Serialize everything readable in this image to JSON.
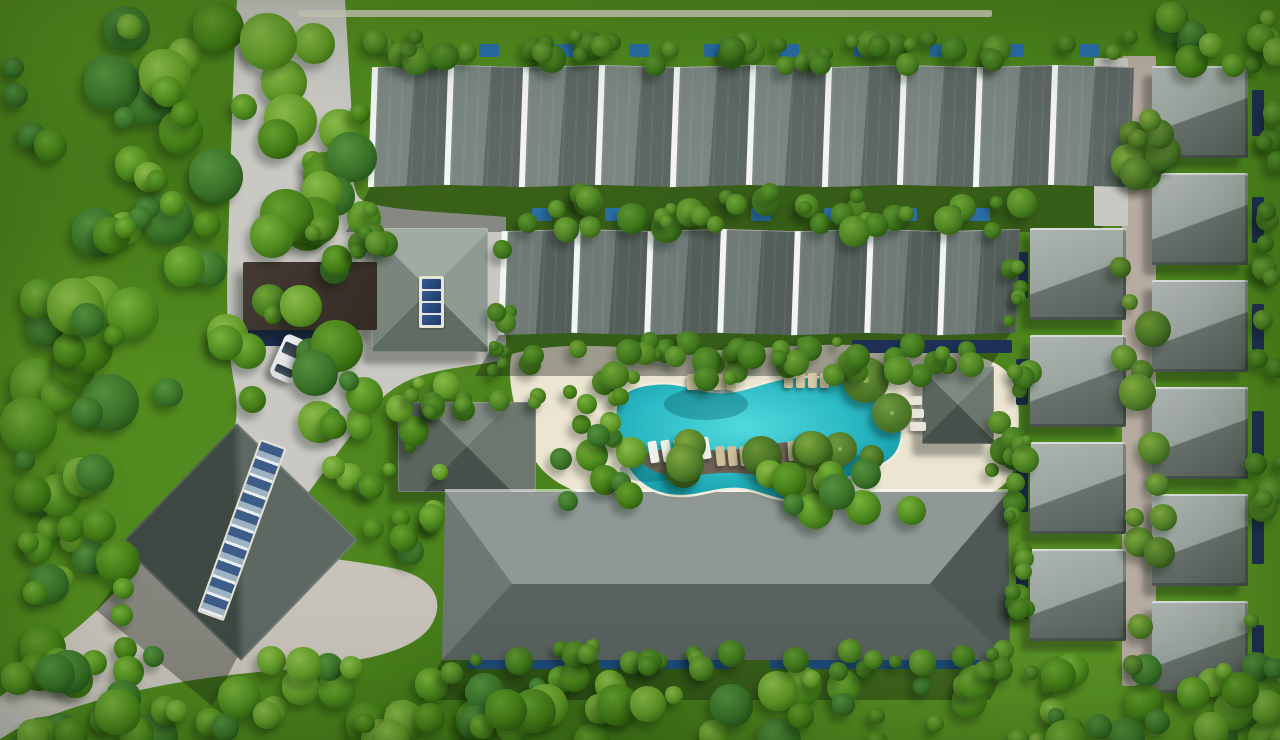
{
  "scene": {
    "description": "aerial-masterplan-render-of-tropical-villa-resort",
    "view": "top-down-birds-eye",
    "time_of_day": "midday-sun-from-upper-right"
  },
  "palette": {
    "grassA": "#5a9322",
    "grassB": "#4b831c",
    "grassC": "#55901f",
    "road": "#c9c8c3",
    "plaza": "#c8c3ba",
    "corridor": "#b7aca2",
    "sand": "#ece5d2",
    "wall": "#dbd7ca",
    "poolLight": "#51dade",
    "poolMid": "#2cbac4",
    "poolDeep": "#129aa8",
    "deck": "#6e6257",
    "navy": "#1e3055",
    "plunge": "#2a6ea8",
    "lap": "#1d4a78",
    "rowGap": "#f2f5f2",
    "villaA": "#adb5b1",
    "villaB": "#9aa39e",
    "villaC": "#68716c",
    "villaD": "#565f5a",
    "longLight": "#8f9894",
    "longDark": "#58625e",
    "longHipL": "#6d7773",
    "longHipR": "#4e5854"
  },
  "townhouse_rows": [
    {
      "name": "townhouse-row-north",
      "x": 370,
      "y": 66,
      "w": 756,
      "h": 120,
      "units": 10,
      "zig": 1.6,
      "lean": -2,
      "light": "#7b8683",
      "dark": "#5d6764"
    },
    {
      "name": "townhouse-row-middle",
      "x": 500,
      "y": 230,
      "w": 512,
      "h": 104,
      "units": 7,
      "zig": 1.8,
      "lean": -2,
      "light": "#6f7a77",
      "dark": "#545e5b"
    }
  ],
  "villas": {
    "w": 96,
    "h": 92,
    "columns": [
      {
        "name": "villa-column-west",
        "x": 1030,
        "rows": [
          228,
          335,
          442,
          549
        ]
      },
      {
        "name": "villa-column-east",
        "x": 1152,
        "rows": [
          66,
          173,
          280,
          387,
          494,
          601
        ]
      }
    ]
  },
  "pavilions": [
    {
      "name": "clubhouse",
      "x": 372,
      "y": 228,
      "w": 116,
      "h": 124,
      "cls": "pav-club",
      "skylight": true
    },
    {
      "name": "west-pavilion",
      "x": 398,
      "y": 402,
      "w": 138,
      "h": 90,
      "cls": "pav-dark",
      "skylight": false
    },
    {
      "name": "east-pavilion",
      "x": 922,
      "y": 366,
      "w": 72,
      "h": 78,
      "cls": "pav-dark",
      "skylight": false
    }
  ],
  "rotated_building": {
    "name": "event-hall",
    "x": 155,
    "y": 458,
    "size": 168,
    "angle": 44,
    "skylight": {
      "x": 228,
      "y": 438,
      "w": 24,
      "h": 180,
      "angle": 20
    }
  },
  "club_skylight": {
    "x": 419,
    "y": 276,
    "w": 25,
    "h": 52,
    "panels": 4
  },
  "canopy": {
    "x": 243,
    "y": 262,
    "w": 134,
    "h": 68
  },
  "planters": [
    {
      "x": 252,
      "y": 284,
      "d": 34
    },
    {
      "x": 264,
      "y": 306,
      "d": 18
    }
  ],
  "car": {
    "x": 276,
    "y": 336,
    "w": 27,
    "h": 46,
    "angle": 24
  },
  "wall": {
    "x": 298,
    "y": 10,
    "w": 694,
    "h": 7
  },
  "paths": [
    {
      "name": "villa-lane",
      "x": 1122,
      "y": 56,
      "w": 34,
      "h": 630,
      "color": "corridor"
    },
    {
      "name": "north-row-path",
      "x": 1094,
      "y": 58,
      "w": 34,
      "h": 168,
      "color": "road"
    }
  ],
  "pond_strips": [
    {
      "name": "canopy-pond",
      "x": 248,
      "y": 328,
      "w": 100,
      "h": 18
    },
    {
      "name": "east-pavilion-pond",
      "x": 852,
      "y": 340,
      "w": 160,
      "h": 13
    }
  ],
  "lap_pools": [
    {
      "x": 468,
      "y": 654,
      "w": 100,
      "h": 15
    },
    {
      "x": 600,
      "y": 654,
      "w": 130,
      "h": 15
    },
    {
      "x": 770,
      "y": 654,
      "w": 140,
      "h": 15
    },
    {
      "x": 935,
      "y": 654,
      "w": 70,
      "h": 15
    }
  ],
  "plunge_row1": {
    "y": 44,
    "w": 20,
    "h": 13,
    "xs": [
      404,
      479,
      554,
      629,
      704,
      779,
      854,
      929,
      1004,
      1079
    ]
  },
  "plunge_row2": {
    "y": 208,
    "w": 20,
    "h": 13,
    "xs": [
      532,
      605,
      678,
      751,
      824,
      897,
      970
    ]
  },
  "villa_plunge": {
    "west_x": 1016,
    "east_x": 1252,
    "w": 12,
    "h": 46,
    "dy": 24
  },
  "umbrellas": [
    {
      "x": 866,
      "y": 380,
      "d": 46
    },
    {
      "x": 892,
      "y": 413,
      "d": 40
    },
    {
      "x": 840,
      "y": 449,
      "d": 34
    }
  ],
  "lounger_groups": [
    {
      "name": "island-west-loungers",
      "x": 649,
      "y": 441,
      "n": 5,
      "dx": 13,
      "dy": -1,
      "w": 9,
      "h": 22,
      "angle": -10,
      "color": "#eef0ea"
    },
    {
      "name": "island-mid-loungers",
      "x": 716,
      "y": 446,
      "n": 4,
      "dx": 12,
      "dy": 0,
      "w": 9,
      "h": 20,
      "angle": -6,
      "color": "#cfc09c"
    },
    {
      "name": "island-east-loungers",
      "x": 788,
      "y": 441,
      "n": 5,
      "dx": 12,
      "dy": 0,
      "w": 9,
      "h": 20,
      "angle": -4,
      "color": "#cfc09c"
    },
    {
      "name": "north-beach-loungers-a",
      "x": 687,
      "y": 374,
      "n": 4,
      "dx": 13,
      "dy": 0,
      "w": 10,
      "h": 16,
      "angle": 0,
      "color": "#d8caa6"
    },
    {
      "name": "north-beach-loungers-b",
      "x": 784,
      "y": 373,
      "n": 4,
      "dx": 12,
      "dy": 0,
      "w": 9,
      "h": 15,
      "angle": 0,
      "color": "#d8caa6"
    },
    {
      "name": "east-beach-loungers",
      "x": 906,
      "y": 396,
      "n": 3,
      "dx": 2,
      "dy": 13,
      "w": 16,
      "h": 9,
      "angle": 0,
      "color": "#e9e5d8"
    }
  ],
  "vegetation": {
    "tones": {
      "forest": [
        [
          "#79b13b",
          "#4e8a1e",
          "#2f6110"
        ],
        [
          "#659f2e",
          "#447d17",
          "#28550c"
        ],
        [
          "#8aba4a",
          "#629a28",
          "#3b6d12"
        ],
        [
          "#55913f",
          "#3a7328",
          "#224f16"
        ]
      ],
      "palm": [
        [
          "#7fa83e",
          "#52802a",
          "#2f5716"
        ],
        [
          "#6a9435",
          "#466f24",
          "#274912"
        ]
      ],
      "hedge": [
        [
          "#5d9430",
          "#3f751c",
          "#24500e"
        ],
        [
          "#6fa438",
          "#4c8122",
          "#2c5a11"
        ]
      ]
    },
    "regions": [
      {
        "name": "top-left-forest",
        "x": 0,
        "y": 0,
        "w": 362,
        "h": 428,
        "count": 85,
        "min": 20,
        "max": 58,
        "tone": "forest"
      },
      {
        "name": "left-forest",
        "x": 0,
        "y": 428,
        "w": 128,
        "h": 250,
        "count": 26,
        "min": 18,
        "max": 48,
        "tone": "forest"
      },
      {
        "name": "bottom-left-forest",
        "x": 0,
        "y": 645,
        "w": 400,
        "h": 95,
        "count": 34,
        "min": 18,
        "max": 46,
        "tone": "forest"
      },
      {
        "name": "bottom-mid-forest",
        "x": 390,
        "y": 660,
        "w": 680,
        "h": 80,
        "count": 42,
        "min": 16,
        "max": 44,
        "tone": "forest"
      },
      {
        "name": "bottom-right-forest",
        "x": 1040,
        "y": 650,
        "w": 240,
        "h": 90,
        "count": 26,
        "min": 16,
        "max": 44,
        "tone": "forest"
      },
      {
        "name": "right-edge-hedge",
        "x": 1244,
        "y": 50,
        "w": 36,
        "h": 600,
        "count": 20,
        "min": 14,
        "max": 30,
        "tone": "hedge"
      },
      {
        "name": "top-right-corner",
        "x": 1140,
        "y": 0,
        "w": 140,
        "h": 64,
        "count": 12,
        "min": 16,
        "max": 36,
        "tone": "forest"
      },
      {
        "name": "north-row-top-hedge",
        "x": 352,
        "y": 28,
        "w": 780,
        "h": 36,
        "count": 46,
        "min": 12,
        "max": 30,
        "tone": "hedge"
      },
      {
        "name": "between-rows-hedge",
        "x": 478,
        "y": 182,
        "w": 560,
        "h": 48,
        "count": 36,
        "min": 12,
        "max": 32,
        "tone": "hedge"
      },
      {
        "name": "row2-south-hedge",
        "x": 500,
        "y": 330,
        "w": 515,
        "h": 34,
        "count": 22,
        "min": 10,
        "max": 26,
        "tone": "hedge"
      },
      {
        "name": "pool-north-garden",
        "x": 560,
        "y": 338,
        "w": 450,
        "h": 44,
        "count": 24,
        "min": 12,
        "max": 30,
        "tone": "hedge"
      },
      {
        "name": "pool-west-garden",
        "x": 548,
        "y": 380,
        "w": 90,
        "h": 125,
        "count": 16,
        "min": 14,
        "max": 34,
        "tone": "forest"
      },
      {
        "name": "pool-island-palms",
        "x": 640,
        "y": 425,
        "w": 230,
        "h": 62,
        "count": 9,
        "min": 24,
        "max": 44,
        "tone": "palm"
      },
      {
        "name": "pool-south-trees",
        "x": 740,
        "y": 455,
        "w": 170,
        "h": 55,
        "count": 10,
        "min": 20,
        "max": 40,
        "tone": "forest"
      },
      {
        "name": "pool-east-garden",
        "x": 985,
        "y": 355,
        "w": 50,
        "h": 160,
        "count": 14,
        "min": 12,
        "max": 30,
        "tone": "hedge"
      },
      {
        "name": "villa-lane-palms",
        "x": 1110,
        "y": 60,
        "w": 54,
        "h": 620,
        "count": 26,
        "min": 16,
        "max": 38,
        "tone": "palm"
      },
      {
        "name": "villa-west-hedge",
        "x": 1000,
        "y": 222,
        "w": 30,
        "h": 450,
        "count": 20,
        "min": 10,
        "max": 24,
        "tone": "hedge"
      },
      {
        "name": "canopy-garden",
        "x": 300,
        "y": 200,
        "w": 90,
        "h": 58,
        "count": 9,
        "min": 12,
        "max": 26,
        "tone": "hedge"
      },
      {
        "name": "club-east-hedge",
        "x": 486,
        "y": 222,
        "w": 26,
        "h": 148,
        "count": 9,
        "min": 10,
        "max": 22,
        "tone": "hedge"
      },
      {
        "name": "mid-west-garden",
        "x": 318,
        "y": 356,
        "w": 130,
        "h": 120,
        "count": 14,
        "min": 12,
        "max": 30,
        "tone": "forest"
      },
      {
        "name": "west-pavilion-hedge",
        "x": 388,
        "y": 378,
        "w": 170,
        "h": 36,
        "count": 10,
        "min": 10,
        "max": 24,
        "tone": "hedge"
      },
      {
        "name": "long-building-south-hedge",
        "x": 432,
        "y": 638,
        "w": 600,
        "h": 34,
        "count": 30,
        "min": 12,
        "max": 28,
        "tone": "hedge"
      },
      {
        "name": "event-hall-garden",
        "x": 340,
        "y": 470,
        "w": 100,
        "h": 90,
        "count": 10,
        "min": 12,
        "max": 28,
        "tone": "forest"
      }
    ]
  }
}
